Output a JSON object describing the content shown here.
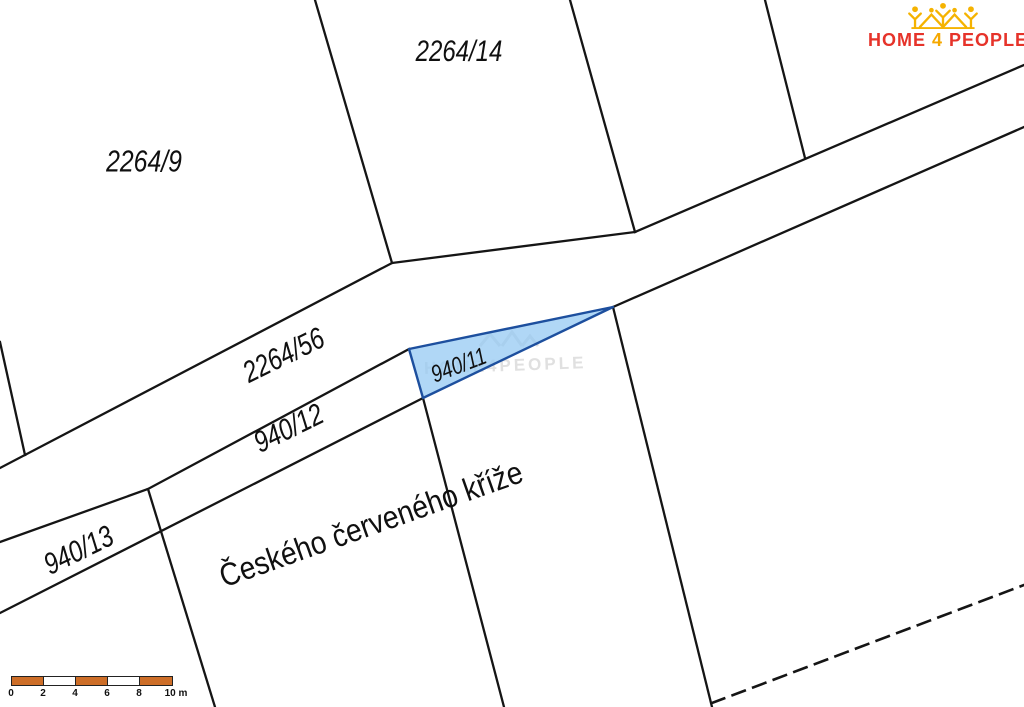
{
  "map": {
    "type": "cadastral-parcel-map",
    "parcels": {
      "p2264_9": "2264/9",
      "p2264_14": "2264/14",
      "p2264_56": "2264/56",
      "p940_12": "940/12",
      "p940_13": "940/13",
      "p940_11": "940/11"
    },
    "highlighted_parcel": "940/11",
    "street_name": "Českého červeného kříže"
  },
  "brand": {
    "word1": "HOME",
    "number": "4",
    "word2": "PEOPLE"
  },
  "scalebar": {
    "ticks": [
      "0",
      "2",
      "4",
      "6",
      "8",
      "10 m"
    ]
  },
  "watermark": {
    "text": "HOME4PEOPLE"
  },
  "colors": {
    "boundary_line": "#151515",
    "highlight_fill": "#a9cdf0",
    "highlight_stroke": "#1d4f9e",
    "scalebar_orange": "#cd6e28",
    "brand_red": "#e6332a",
    "brand_yellow": "#f5a800"
  }
}
